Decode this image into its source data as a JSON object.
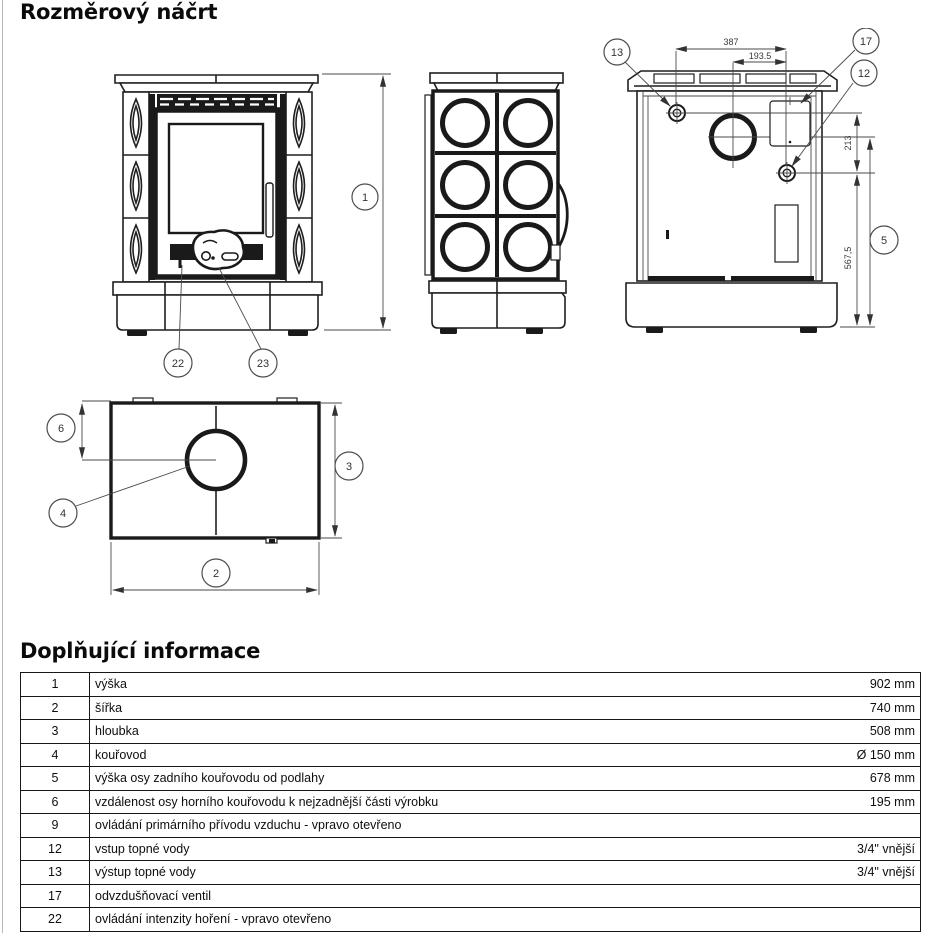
{
  "page": {
    "title": "Rozměrový náčrt",
    "info_title": "Doplňující informace"
  },
  "drawing": {
    "balloons": {
      "b1": "1",
      "b2": "2",
      "b3": "3",
      "b4": "4",
      "b5": "5",
      "b6": "6",
      "b12": "12",
      "b13": "13",
      "b17": "17",
      "b22": "22",
      "b23": "23"
    },
    "dims": {
      "fittings_span": "387",
      "half_span": "193.5",
      "fittings_vertical": "213",
      "lower_fitting_height": "567,5"
    }
  },
  "table": {
    "rows": [
      {
        "num": "1",
        "desc": "výška",
        "value": "902 mm"
      },
      {
        "num": "2",
        "desc": "šířka",
        "value": "740 mm"
      },
      {
        "num": "3",
        "desc": "hloubka",
        "value": "508 mm"
      },
      {
        "num": "4",
        "desc": "kouřovod",
        "value": "Ø 150 mm"
      },
      {
        "num": "5",
        "desc": "výška osy zadního kouřovodu od podlahy",
        "value": "678 mm"
      },
      {
        "num": "6",
        "desc": "vzdálenost osy horního kouřovodu k nejzadnější části výrobku",
        "value": "195 mm"
      },
      {
        "num": "9",
        "desc": "ovládání primárního přívodu vzduchu - vpravo otevřeno",
        "value": ""
      },
      {
        "num": "12",
        "desc": "vstup topné vody",
        "value": "3/4\" vnější"
      },
      {
        "num": "13",
        "desc": "výstup topné vody",
        "value": "3/4\" vnější"
      },
      {
        "num": "17",
        "desc": "odvzdušňovací ventil",
        "value": ""
      },
      {
        "num": "22",
        "desc": "ovládání intenzity hoření - vpravo otevřeno",
        "value": ""
      }
    ]
  }
}
